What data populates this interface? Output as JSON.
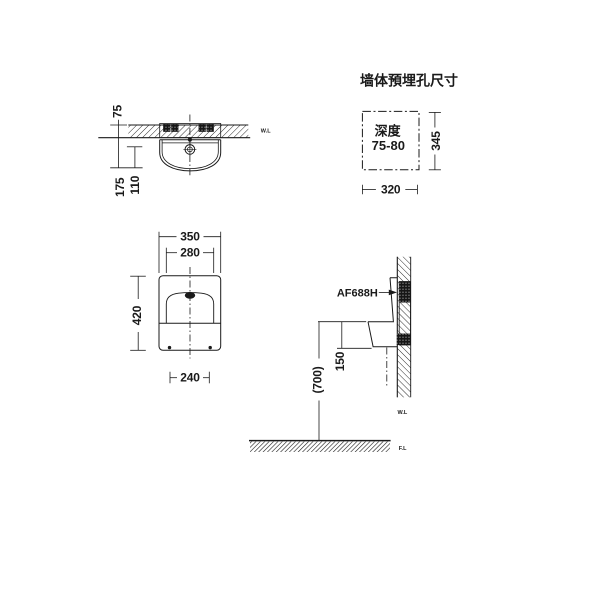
{
  "colors": {
    "background": "#ffffff",
    "ink": "#1a1a1a"
  },
  "detail_panel": {
    "title": "墙体預埋孔尺寸",
    "depth_label": "深度",
    "depth_value": "75-80",
    "height_dim": "345",
    "width_dim": "320"
  },
  "top_view": {
    "wall_thickness_dim": "75",
    "depth_dim": "175",
    "spud_depth_dim": "110",
    "wall_line_marker": "W.L"
  },
  "front_view": {
    "width_dim": "350",
    "inner_width_dim": "280",
    "height_dim": "420",
    "bolt_spacing_dim": "240"
  },
  "side_view": {
    "model_label": "AF688H",
    "lip_to_bottom_dim": "150",
    "rim_height_dim": "(700)",
    "wall_line_marker": "W.L"
  },
  "floor": {
    "floor_line_marker": "F.L"
  }
}
